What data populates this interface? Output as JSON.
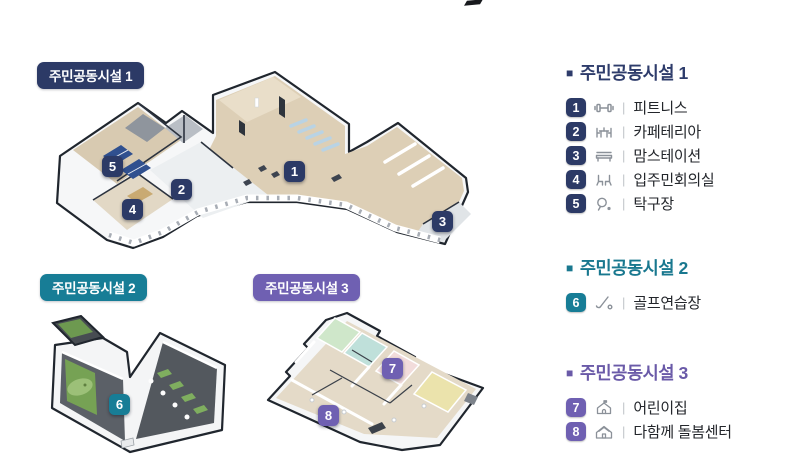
{
  "plans": [
    {
      "label": "주민공동시설 1"
    },
    {
      "label": "주민공동시설 2"
    },
    {
      "label": "주민공동시설 3"
    }
  ],
  "markers": [
    "1",
    "2",
    "3",
    "4",
    "5",
    "6",
    "7",
    "8"
  ],
  "legend": {
    "bullet": "■",
    "separator": "|",
    "sections": [
      {
        "title": "주민공동시설 1",
        "items": [
          {
            "num": "1",
            "icon": "dumbbell-icon",
            "label": "피트니스"
          },
          {
            "num": "2",
            "icon": "cafeteria-table-icon",
            "label": "카페테리아"
          },
          {
            "num": "3",
            "icon": "bench-icon",
            "label": "맘스테이션"
          },
          {
            "num": "4",
            "icon": "meeting-chairs-icon",
            "label": "입주민회의실"
          },
          {
            "num": "5",
            "icon": "table-tennis-icon",
            "label": "탁구장"
          }
        ]
      },
      {
        "title": "주민공동시설 2",
        "items": [
          {
            "num": "6",
            "icon": "golf-club-icon",
            "label": "골프연습장"
          }
        ]
      },
      {
        "title": "주민공동시설 3",
        "items": [
          {
            "num": "7",
            "icon": "daycare-building-icon",
            "label": "어린이집"
          },
          {
            "num": "8",
            "icon": "care-house-icon",
            "label": "다함께 돌봄센터"
          }
        ]
      }
    ]
  },
  "colors": {
    "navy": "#2c3a66",
    "teal": "#177d96",
    "purple": "#6f60b2",
    "wood_floor": "#ddcfb6",
    "dark_floor": "#5b6067",
    "golf_green": "#76a254"
  }
}
